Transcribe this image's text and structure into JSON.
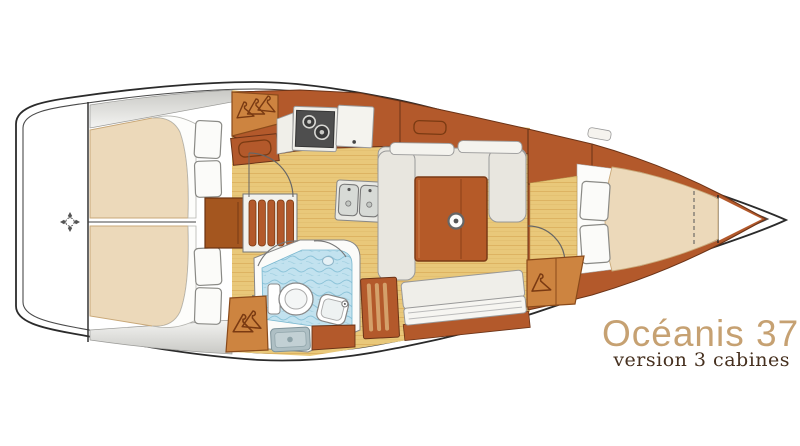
{
  "branding": {
    "model": "Océanis 37",
    "variant": "version 3 cabines"
  },
  "colors": {
    "accent": "#c6a172",
    "variant_text": "#46301f",
    "cabinetry": "#b3592b",
    "cabinetry_dark": "#6b3317",
    "wardrobe": "#cd8440",
    "floor": "#e9c87a",
    "floor_grain": "#d9ae58",
    "mattress": "#ecd9ba",
    "settee": "#e8e6df",
    "table": "#b55a28",
    "bath_floor": "#c2e2ef",
    "bath_wave": "#8fc5da",
    "hull_line": "#2b2b2b"
  },
  "icons": {
    "hanger-icon": "clothes hanger glyph marking hanging lockers",
    "burner-icon": "two concentric circles on stove top",
    "sink-icon": "double stainless basins with drains",
    "toilet-icon": "oval bowl with cistern",
    "shower-drain-icon": "square drain plate",
    "mast-post-icon": "white circle with center dot",
    "datum-crosshair-icon": "circle with four diamond points at stern",
    "berth-split-line": "dashed filler-cushion divider on V-berth"
  }
}
